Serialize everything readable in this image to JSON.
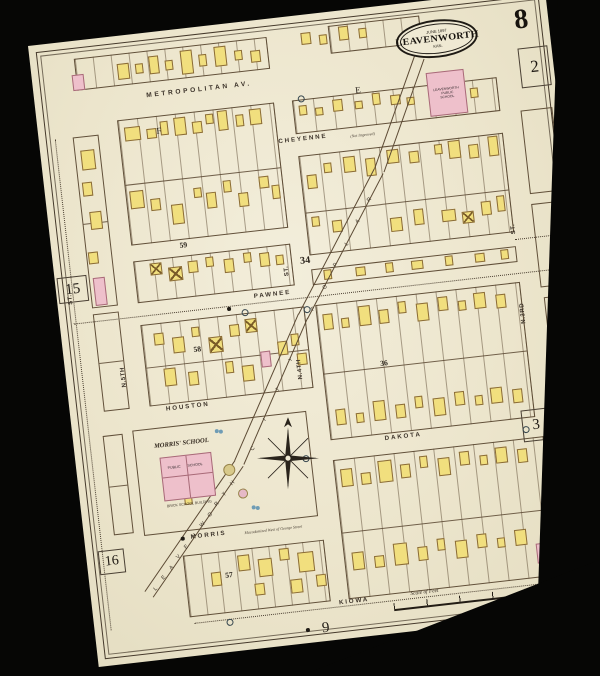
{
  "sheet": {
    "number": "8",
    "city_stamp": {
      "date": "JUNE 1897",
      "city": "LEAVENWORTH",
      "state": "KAN."
    }
  },
  "scale": {
    "label": "Scale of Feet"
  },
  "colors": {
    "paper": "#efe9d3",
    "background": "#060605",
    "frame_building": "#f1df7e",
    "brick_building": "#eec0cb",
    "line": "#5c4a34"
  },
  "landmarks": {
    "morris_school": {
      "title": "MORRIS' SCHOOL",
      "room1": "PUBLIC",
      "room2": "SCHOOL",
      "caption": "BRICK SCHOOL BUILDING"
    },
    "public_school": {
      "line1": "LEAVENWORTH",
      "line2": "PUBLIC",
      "line3": "SCHOOL"
    }
  },
  "streets_h": [
    {
      "label": "METROPOLITAN  AV.",
      "x": 112,
      "y": 59,
      "scale": 0.66,
      "ls": 4
    },
    {
      "label": "CHEYENNE",
      "x": 238,
      "y": 120,
      "scale": 0.62,
      "ls": 3,
      "note": "(Not Improved)",
      "nx": 310,
      "ny": 124
    },
    {
      "label": "PAWNEE",
      "x": 196,
      "y": 271,
      "scale": 0.62,
      "ls": 3
    },
    {
      "label": "HOUSTON",
      "x": 96,
      "y": 373,
      "scale": 0.62,
      "ls": 3
    },
    {
      "label": "DAKOTA",
      "x": 310,
      "y": 427,
      "scale": 0.62,
      "ls": 3
    },
    {
      "label": "MORRIS",
      "x": 106,
      "y": 503,
      "scale": 0.62,
      "ls": 3,
      "note": "Macadamized West of George Street",
      "nx": 160,
      "ny": 506
    },
    {
      "label": "KIOWA",
      "x": 246,
      "y": 585,
      "scale": 0.62,
      "ls": 3
    }
  ],
  "streets_v": [
    {
      "label": "ST.",
      "x": 10,
      "y": 262
    },
    {
      "label": "N.5TH",
      "x": 54,
      "y": 350
    },
    {
      "label": "ST.",
      "x": 228,
      "y": 258
    },
    {
      "label": "N.4TH",
      "x": 230,
      "y": 362
    },
    {
      "label": "ST.",
      "x": 458,
      "y": 242
    },
    {
      "label": "N.3RD",
      "x": 458,
      "y": 332
    }
  ],
  "diagonal_runs": [
    {
      "text": "LEAVENWORTH",
      "x1": 62,
      "y1": 552,
      "x2": 150,
      "y2": 456
    },
    {
      "text": "CITY",
      "x1": 174,
      "y1": 424,
      "x2": 222,
      "y2": 340
    },
    {
      "text": "POPLAR",
      "x1": 250,
      "y1": 292,
      "x2": 318,
      "y2": 190
    }
  ],
  "corridor_segments": [
    [
      54,
      566,
      159,
      -49
    ],
    [
      158,
      446,
      160,
      -60
    ],
    [
      238,
      308,
      164,
      -56
    ],
    [
      330,
      172,
      120,
      -64
    ]
  ],
  "block_numbers": [
    {
      "label": "34",
      "x": 246,
      "y": 238,
      "fs": 12
    },
    {
      "label": "59",
      "x": 128,
      "y": 211,
      "fs": 9
    },
    {
      "label": "58",
      "x": 130,
      "y": 316,
      "fs": 9
    },
    {
      "label": "57",
      "x": 136,
      "y": 544,
      "fs": 9
    },
    {
      "label": "36",
      "x": 314,
      "y": 351,
      "fs": 9
    }
  ],
  "margin_numbers": [
    {
      "label": "15",
      "x": 2,
      "y": 234,
      "w": 30,
      "h": 26,
      "fs": 15,
      "box": true,
      "dot": false
    },
    {
      "label": "16",
      "x": 12,
      "y": 510,
      "w": 26,
      "h": 24,
      "fs": 14,
      "box": true,
      "dot": false
    },
    {
      "label": "2",
      "x": 486,
      "y": 58,
      "w": 30,
      "h": 40,
      "fs": 17,
      "box": true,
      "dot": false
    },
    {
      "label": "3",
      "x": 448,
      "y": 418,
      "w": 28,
      "h": 32,
      "fs": 15,
      "box": true,
      "dot": false
    },
    {
      "label": "9",
      "x": 218,
      "y": 602,
      "w": 24,
      "h": 20,
      "fs": 15,
      "box": false,
      "dot": true
    }
  ],
  "lot_letters": [
    {
      "label": "F",
      "x": 118,
      "y": 94
    },
    {
      "label": "E",
      "x": 320,
      "y": 76
    }
  ],
  "blocks": [
    [
      44,
      18,
      194,
      32,
      18,
      []
    ],
    [
      300,
      14,
      92,
      28,
      18,
      []
    ],
    [
      80,
      84,
      158,
      126,
      19,
      [
        64
      ]
    ],
    [
      80,
      226,
      158,
      42,
      19,
      []
    ],
    [
      80,
      290,
      165,
      82,
      19,
      [
        42
      ]
    ],
    [
      60,
      394,
      175,
      106,
      0,
      []
    ],
    [
      96,
      524,
      142,
      62,
      17,
      []
    ],
    [
      256,
      84,
      206,
      34,
      20,
      []
    ],
    [
      256,
      140,
      206,
      100,
      20,
      [
        56
      ]
    ],
    [
      256,
      254,
      206,
      16,
      0,
      []
    ],
    [
      256,
      290,
      206,
      136,
      20,
      [
        68
      ]
    ],
    [
      256,
      446,
      212,
      140,
      20,
      [
        72
      ]
    ],
    [
      34,
      96,
      26,
      172,
      0,
      [
        86
      ]
    ],
    [
      34,
      274,
      26,
      98,
      0,
      [
        48
      ]
    ],
    [
      30,
      396,
      20,
      100,
      0,
      [
        50
      ]
    ],
    [
      482,
      120,
      32,
      84,
      0,
      []
    ],
    [
      482,
      214,
      32,
      84,
      0,
      []
    ],
    [
      484,
      308,
      30,
      84,
      0,
      []
    ],
    [
      486,
      404,
      26,
      52,
      0,
      []
    ]
  ],
  "dashes": [
    [
      14,
      281,
      498
    ],
    [
      100,
      592,
      366
    ],
    [
      462,
      247,
      50
    ]
  ],
  "vdashes": [
    [
      16,
      96,
      494
    ]
  ],
  "buildings": [
    [
      40,
      34,
      12,
      16,
      "P"
    ],
    [
      86,
      28,
      12,
      16,
      "Y"
    ],
    [
      104,
      30,
      8,
      10,
      "Y"
    ],
    [
      118,
      24,
      10,
      18,
      "Y"
    ],
    [
      134,
      30,
      8,
      10,
      "Y"
    ],
    [
      150,
      22,
      12,
      24,
      "Y"
    ],
    [
      168,
      28,
      8,
      12,
      "Y"
    ],
    [
      184,
      22,
      12,
      20,
      "Y"
    ],
    [
      204,
      28,
      8,
      10,
      "Y"
    ],
    [
      220,
      30,
      10,
      12,
      "Y"
    ],
    [
      272,
      18,
      10,
      12,
      "Y"
    ],
    [
      290,
      22,
      8,
      10,
      "Y"
    ],
    [
      310,
      16,
      10,
      14,
      "Y"
    ],
    [
      330,
      20,
      8,
      10,
      "Y"
    ],
    [
      86,
      92,
      16,
      14,
      "Y"
    ],
    [
      108,
      96,
      10,
      10,
      "Y"
    ],
    [
      122,
      90,
      8,
      14,
      "Y"
    ],
    [
      136,
      88,
      12,
      18,
      "Y"
    ],
    [
      154,
      94,
      10,
      12,
      "Y"
    ],
    [
      168,
      88,
      8,
      10,
      "Y"
    ],
    [
      180,
      86,
      10,
      20,
      "Y"
    ],
    [
      198,
      92,
      8,
      12,
      "Y"
    ],
    [
      212,
      88,
      12,
      16,
      "Y"
    ],
    [
      84,
      156,
      14,
      18,
      "Y"
    ],
    [
      104,
      166,
      10,
      12,
      "Y"
    ],
    [
      124,
      174,
      12,
      20,
      "Y"
    ],
    [
      148,
      160,
      8,
      10,
      "Y"
    ],
    [
      160,
      166,
      10,
      16,
      "Y"
    ],
    [
      178,
      156,
      8,
      12,
      "Y"
    ],
    [
      192,
      170,
      10,
      14,
      "Y"
    ],
    [
      214,
      156,
      10,
      12,
      "Y"
    ],
    [
      226,
      166,
      8,
      14,
      "Y"
    ],
    [
      96,
      230,
      12,
      12,
      "X"
    ],
    [
      114,
      236,
      14,
      14,
      "X"
    ],
    [
      134,
      232,
      10,
      12,
      "Y"
    ],
    [
      152,
      230,
      8,
      10,
      "Y"
    ],
    [
      170,
      234,
      10,
      14,
      "Y"
    ],
    [
      190,
      230,
      8,
      10,
      "Y"
    ],
    [
      206,
      232,
      10,
      14,
      "Y"
    ],
    [
      222,
      236,
      8,
      10,
      "Y"
    ],
    [
      40,
      110,
      14,
      20,
      "Y"
    ],
    [
      38,
      142,
      10,
      14,
      "Y"
    ],
    [
      42,
      172,
      12,
      18,
      "Y"
    ],
    [
      36,
      212,
      10,
      12,
      "Y"
    ],
    [
      38,
      238,
      12,
      28,
      "P"
    ],
    [
      92,
      300,
      10,
      12,
      "Y"
    ],
    [
      110,
      306,
      12,
      16,
      "Y"
    ],
    [
      130,
      298,
      8,
      10,
      "Y"
    ],
    [
      146,
      310,
      14,
      16,
      "X"
    ],
    [
      168,
      300,
      10,
      12,
      "Y"
    ],
    [
      184,
      296,
      12,
      14,
      "X"
    ],
    [
      196,
      330,
      10,
      16,
      "P"
    ],
    [
      214,
      322,
      10,
      14,
      "Y"
    ],
    [
      228,
      316,
      8,
      12,
      "Y"
    ],
    [
      98,
      336,
      12,
      18,
      "Y"
    ],
    [
      122,
      342,
      10,
      14,
      "Y"
    ],
    [
      160,
      336,
      8,
      12,
      "Y"
    ],
    [
      176,
      342,
      12,
      16,
      "Y"
    ],
    [
      232,
      336,
      10,
      12,
      "Y"
    ],
    [
      122,
      544,
      10,
      14,
      "Y"
    ],
    [
      150,
      530,
      12,
      16,
      "Y"
    ],
    [
      164,
      560,
      10,
      12,
      "Y"
    ],
    [
      170,
      536,
      14,
      18,
      "Y"
    ],
    [
      192,
      528,
      10,
      12,
      "Y"
    ],
    [
      200,
      560,
      12,
      14,
      "Y"
    ],
    [
      210,
      534,
      16,
      20,
      "Y"
    ],
    [
      226,
      558,
      10,
      12,
      "Y"
    ],
    [
      262,
      90,
      8,
      10,
      "Y"
    ],
    [
      278,
      94,
      8,
      8,
      "Y"
    ],
    [
      296,
      88,
      10,
      12,
      "Y"
    ],
    [
      318,
      92,
      8,
      8,
      "Y"
    ],
    [
      336,
      86,
      8,
      12,
      "Y"
    ],
    [
      354,
      90,
      10,
      10,
      "Y"
    ],
    [
      370,
      94,
      8,
      8,
      "Y"
    ],
    [
      434,
      92,
      8,
      10,
      "Y"
    ],
    [
      262,
      160,
      10,
      14,
      "Y"
    ],
    [
      280,
      150,
      8,
      10,
      "Y"
    ],
    [
      300,
      146,
      12,
      16,
      "Y"
    ],
    [
      322,
      150,
      10,
      18,
      "Y"
    ],
    [
      344,
      144,
      12,
      14,
      "Y"
    ],
    [
      366,
      148,
      10,
      12,
      "Y"
    ],
    [
      392,
      144,
      8,
      10,
      "Y"
    ],
    [
      406,
      142,
      12,
      18,
      "Y"
    ],
    [
      426,
      148,
      10,
      14,
      "Y"
    ],
    [
      446,
      142,
      10,
      20,
      "Y"
    ],
    [
      262,
      202,
      8,
      10,
      "Y"
    ],
    [
      282,
      208,
      10,
      12,
      "Y"
    ],
    [
      340,
      212,
      12,
      14,
      "Y"
    ],
    [
      364,
      206,
      10,
      16,
      "Y"
    ],
    [
      392,
      210,
      14,
      12,
      "Y"
    ],
    [
      412,
      214,
      12,
      12,
      "X"
    ],
    [
      432,
      206,
      10,
      14,
      "Y"
    ],
    [
      448,
      202,
      8,
      16,
      "Y"
    ],
    [
      268,
      256,
      8,
      10,
      "Y"
    ],
    [
      300,
      257,
      10,
      9,
      "Y"
    ],
    [
      330,
      256,
      8,
      10,
      "Y"
    ],
    [
      356,
      257,
      12,
      9,
      "Y"
    ],
    [
      390,
      256,
      8,
      10,
      "Y"
    ],
    [
      420,
      257,
      10,
      9,
      "Y"
    ],
    [
      446,
      256,
      8,
      10,
      "Y"
    ],
    [
      262,
      300,
      10,
      16,
      "Y"
    ],
    [
      280,
      306,
      8,
      10,
      "Y"
    ],
    [
      298,
      296,
      12,
      20,
      "Y"
    ],
    [
      318,
      302,
      10,
      14,
      "Y"
    ],
    [
      338,
      296,
      8,
      12,
      "Y"
    ],
    [
      356,
      300,
      12,
      18,
      "Y"
    ],
    [
      378,
      296,
      10,
      14,
      "Y"
    ],
    [
      398,
      302,
      8,
      10,
      "Y"
    ],
    [
      414,
      296,
      12,
      16,
      "Y"
    ],
    [
      436,
      300,
      10,
      14,
      "Y"
    ],
    [
      264,
      396,
      10,
      16,
      "Y"
    ],
    [
      284,
      402,
      8,
      10,
      "Y"
    ],
    [
      302,
      392,
      12,
      20,
      "Y"
    ],
    [
      324,
      398,
      10,
      14,
      "Y"
    ],
    [
      344,
      392,
      8,
      12,
      "Y"
    ],
    [
      362,
      396,
      12,
      18,
      "Y"
    ],
    [
      384,
      392,
      10,
      14,
      "Y"
    ],
    [
      404,
      398,
      8,
      10,
      "Y"
    ],
    [
      420,
      392,
      12,
      16,
      "Y"
    ],
    [
      442,
      396,
      10,
      14,
      "Y"
    ],
    [
      262,
      456,
      12,
      18,
      "Y"
    ],
    [
      282,
      462,
      10,
      12,
      "Y"
    ],
    [
      300,
      452,
      14,
      22,
      "Y"
    ],
    [
      322,
      458,
      10,
      14,
      "Y"
    ],
    [
      342,
      452,
      8,
      12,
      "Y"
    ],
    [
      360,
      456,
      12,
      18,
      "Y"
    ],
    [
      382,
      452,
      10,
      14,
      "Y"
    ],
    [
      402,
      458,
      8,
      10,
      "Y"
    ],
    [
      418,
      452,
      12,
      16,
      "Y"
    ],
    [
      440,
      456,
      10,
      14,
      "Y"
    ],
    [
      264,
      540,
      12,
      18,
      "Y"
    ],
    [
      286,
      546,
      10,
      12,
      "Y"
    ],
    [
      306,
      536,
      14,
      22,
      "Y"
    ],
    [
      330,
      542,
      10,
      14,
      "Y"
    ],
    [
      350,
      536,
      8,
      12,
      "Y"
    ],
    [
      368,
      540,
      12,
      18,
      "Y"
    ],
    [
      390,
      536,
      10,
      14,
      "Y"
    ],
    [
      410,
      542,
      8,
      10,
      "Y"
    ],
    [
      428,
      536,
      12,
      16,
      "Y"
    ],
    [
      448,
      552,
      14,
      20,
      "P"
    ],
    [
      450,
      572,
      12,
      12,
      "XP"
    ],
    [
      104,
      466,
      8,
      8,
      "Y"
    ]
  ],
  "hydrants": [
    [
      182,
      286
    ],
    [
      244,
      290
    ],
    [
      448,
      434
    ],
    [
      132,
      592
    ],
    [
      262,
      80
    ],
    [
      226,
      438
    ]
  ],
  "dots": [
    [
      168,
      282
    ],
    [
      96,
      505
    ]
  ],
  "trees": [
    {
      "x": 146,
      "y": 438,
      "d": 12,
      "fill": "#d8c98a"
    },
    {
      "x": 158,
      "y": 464,
      "d": 10,
      "fill": "#e6b9c7"
    }
  ],
  "water_symbols": [
    [
      142,
      402
    ],
    [
      170,
      482
    ]
  ],
  "plate": {
    "x": 462,
    "y": 512,
    "w": 30,
    "h": 16
  }
}
